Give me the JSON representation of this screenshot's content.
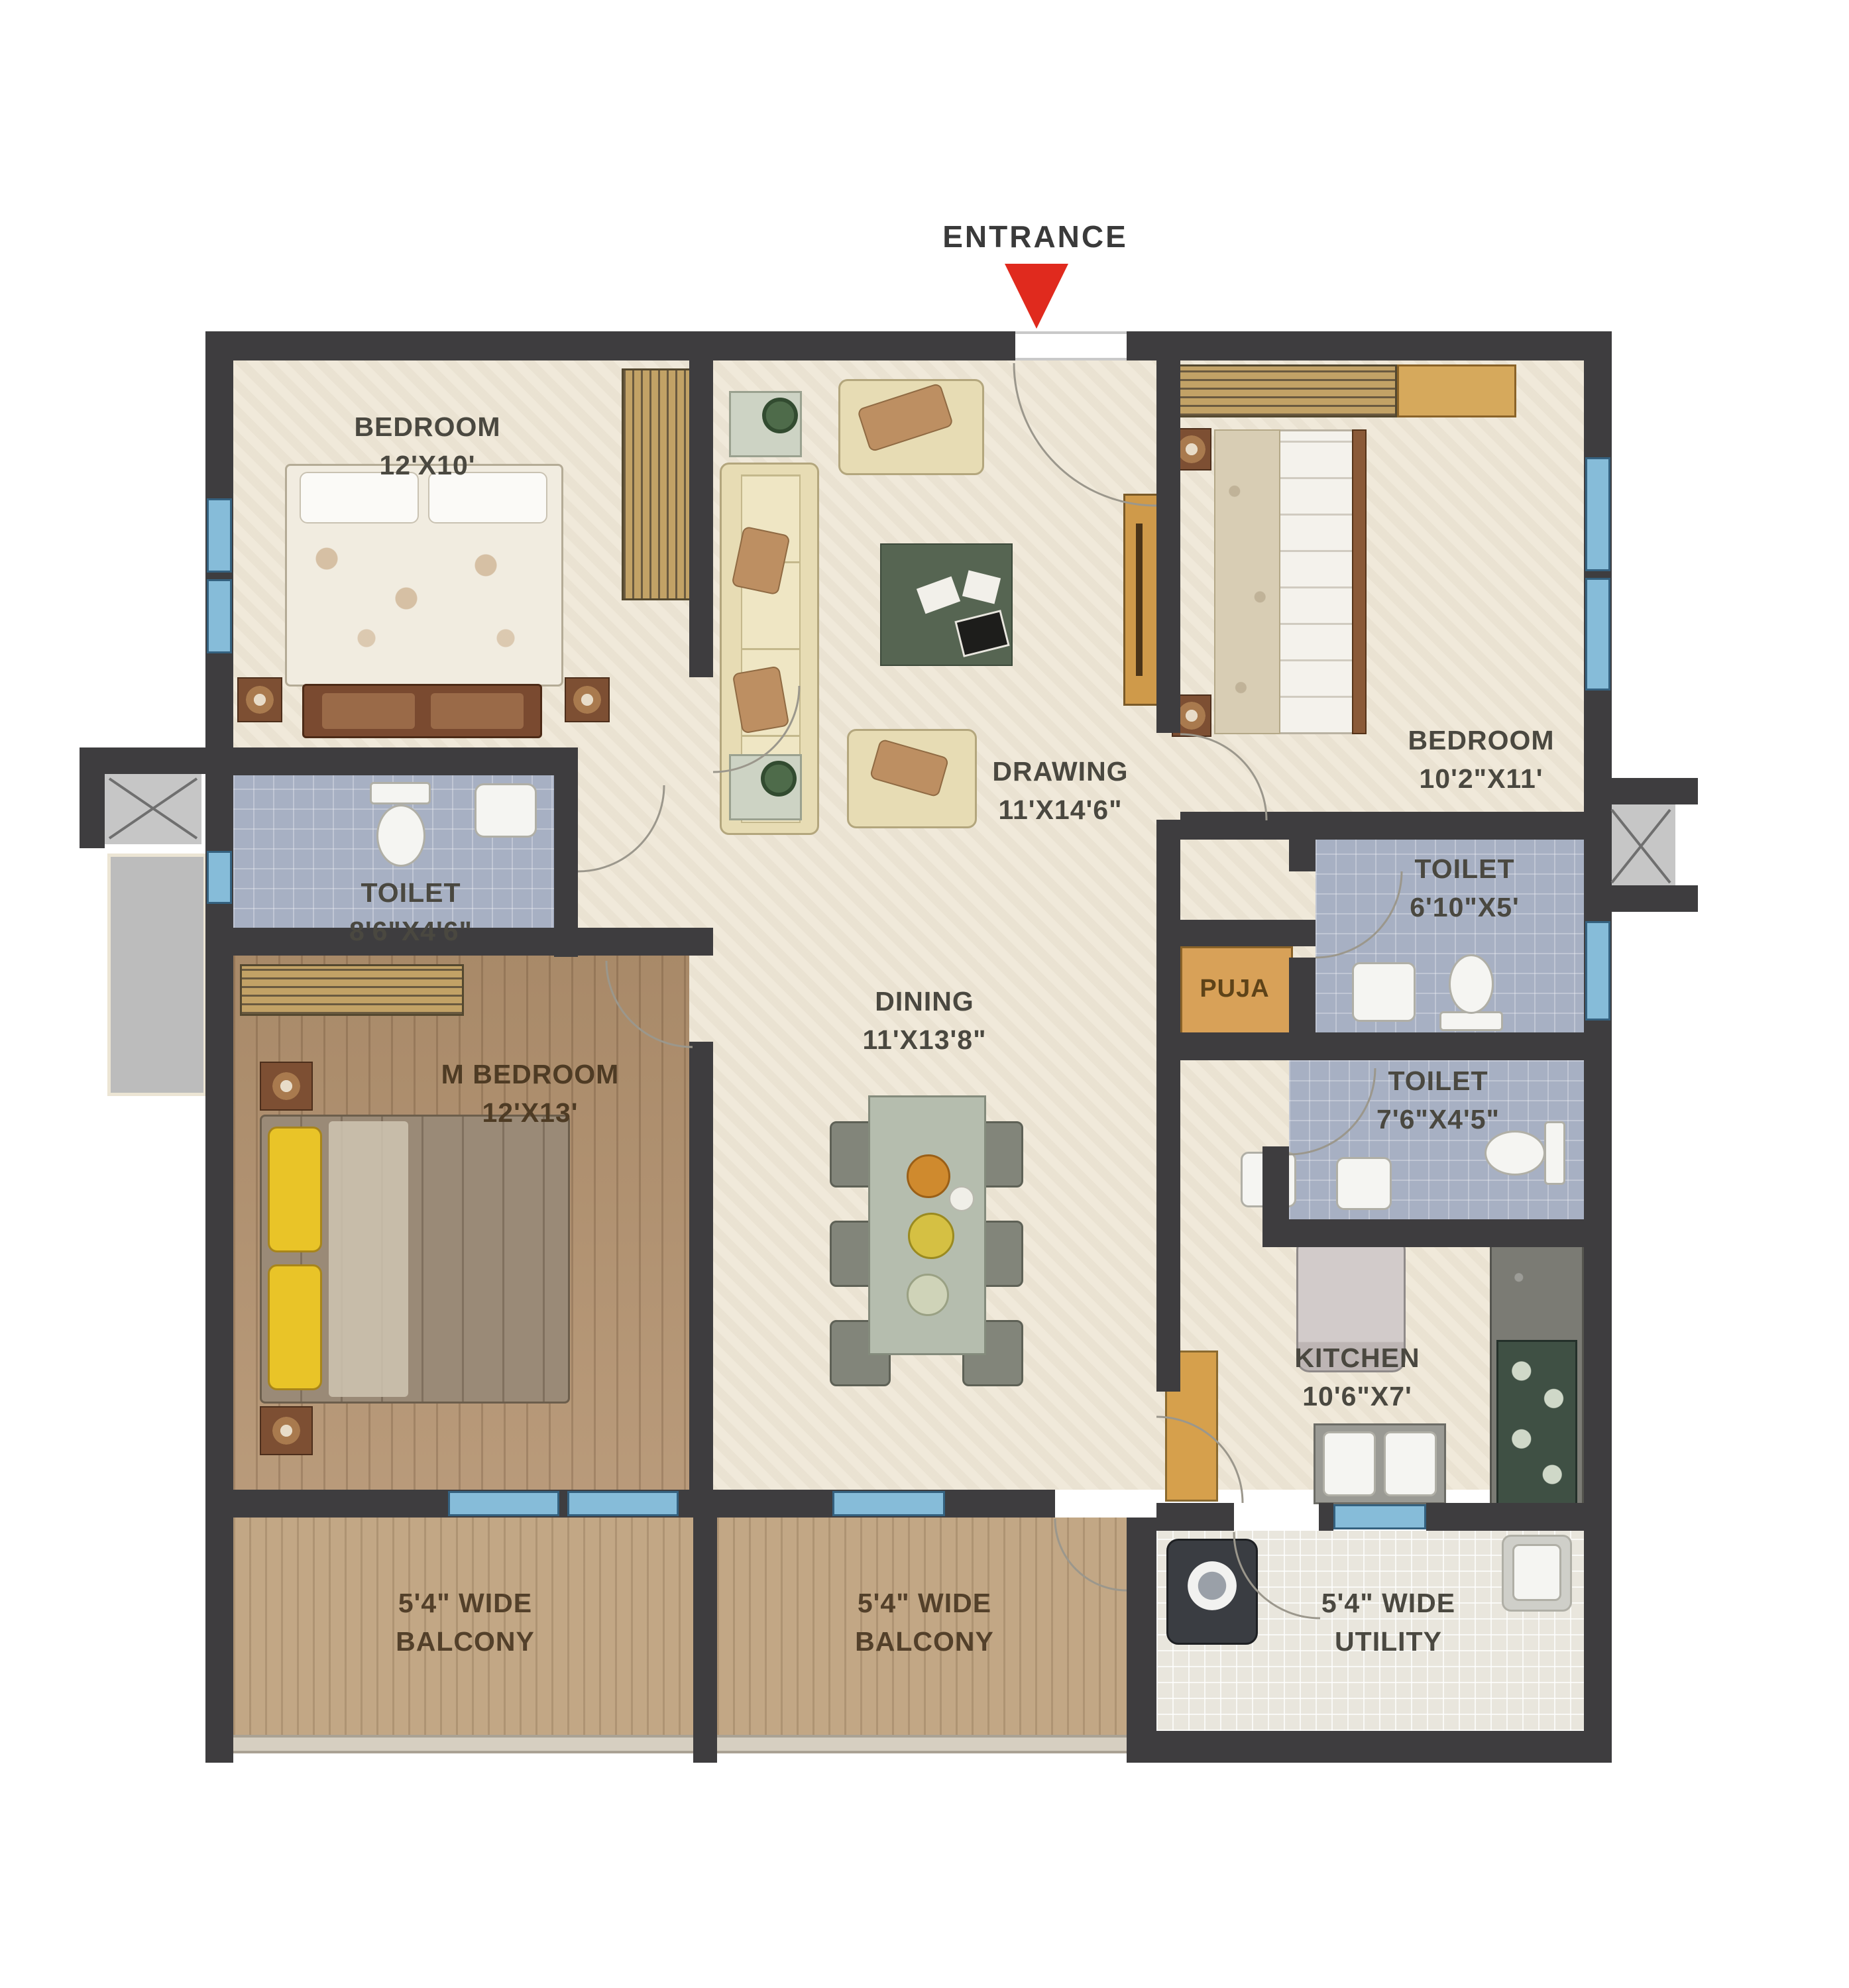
{
  "entrance": {
    "label": "ENTRANCE"
  },
  "rooms": [
    {
      "key": "bedroom-1",
      "name": "BEDROOM",
      "dims": "12'X10'"
    },
    {
      "key": "drawing",
      "name": "DRAWING",
      "dims": "11'X14'6\""
    },
    {
      "key": "bedroom-2",
      "name": "BEDROOM",
      "dims": "10'2\"X11'"
    },
    {
      "key": "toilet-1",
      "name": "TOILET",
      "dims": "8'6\"X4'6\""
    },
    {
      "key": "dining",
      "name": "DINING",
      "dims": "11'X13'8\""
    },
    {
      "key": "toilet-2",
      "name": "TOILET",
      "dims": "6'10\"X5'"
    },
    {
      "key": "puja",
      "name": "PUJA",
      "dims": ""
    },
    {
      "key": "toilet-3",
      "name": "TOILET",
      "dims": "7'6\"X4'5\""
    },
    {
      "key": "m-bedroom",
      "name": "M BEDROOM",
      "dims": "12'X13'"
    },
    {
      "key": "kitchen",
      "name": "KITCHEN",
      "dims": "10'6\"X7'"
    },
    {
      "key": "balcony-1",
      "name": "5'4\" WIDE",
      "dims": "BALCONY"
    },
    {
      "key": "balcony-2",
      "name": "5'4\" WIDE",
      "dims": "BALCONY"
    },
    {
      "key": "utility",
      "name": "5'4\" WIDE",
      "dims": "UTILITY"
    }
  ],
  "colors": {
    "wall": "#3e3d3f",
    "entrance_arrow": "#e02a1e",
    "window_blue": "#86bcd9",
    "toilet_floor": "#a7b0c3",
    "master_wood_floor": "#b3926f",
    "balcony_wood_floor": "#c2a785",
    "cream_floor": "#efe8d8",
    "puja_floor": "#d8a158",
    "label_text": "#4a4840"
  }
}
